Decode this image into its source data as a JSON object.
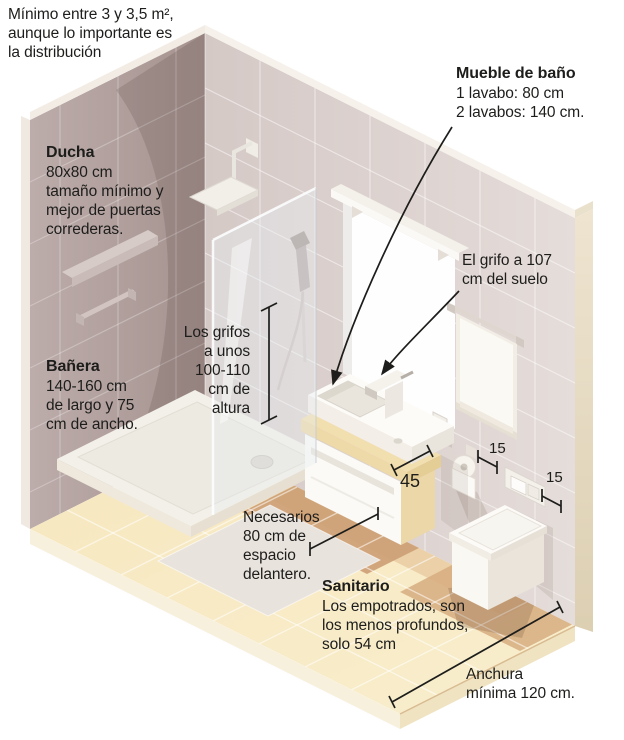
{
  "figure": "Isometric bathroom dimensions infographic",
  "colors": {
    "left_wall": "#b2a19e",
    "right_wall": "#ddd3d0",
    "floor": "#f7e9c4",
    "floor_shadow_tan": "#cfa377",
    "counter_cream": "#f2dfb0",
    "text": "#1d1d1b",
    "line": "#1d1d1b"
  },
  "annotations": {
    "intro": {
      "lines": [
        "Mínimo entre 3 y 3,5 m²,",
        "aunque lo importante es",
        "la distribución"
      ]
    },
    "ducha": {
      "title": "Ducha",
      "lines": [
        "80x80 cm",
        "tamaño mínimo y",
        "mejor de puertas",
        "correderas."
      ]
    },
    "banera": {
      "title": "Bañera",
      "lines": [
        "140-160 cm",
        "de largo y 75",
        "cm de ancho."
      ]
    },
    "mueble": {
      "title": "Mueble de baño",
      "lines": [
        "1 lavabo: 80 cm",
        "2 lavabos: 140 cm."
      ]
    },
    "grifo_suelo": {
      "lines": [
        "El grifo a 107",
        "cm del suelo"
      ]
    },
    "grifos_altura": {
      "lines": [
        "Los grifos",
        "a unos",
        "100-110",
        "cm de",
        "altura"
      ]
    },
    "espacio": {
      "lines": [
        "Necesarios",
        "80 cm de",
        "espacio",
        "delantero."
      ]
    },
    "sanitario": {
      "title": "Sanitario",
      "lines": [
        "Los empotrados, son",
        "los menos profundos,",
        "solo 54 cm"
      ]
    },
    "anchura": {
      "lines": [
        "Anchura",
        "mínima 120 cm."
      ]
    },
    "dims": {
      "vanity_depth": "45",
      "paper_offset": "15",
      "plate_offset": "15"
    }
  }
}
